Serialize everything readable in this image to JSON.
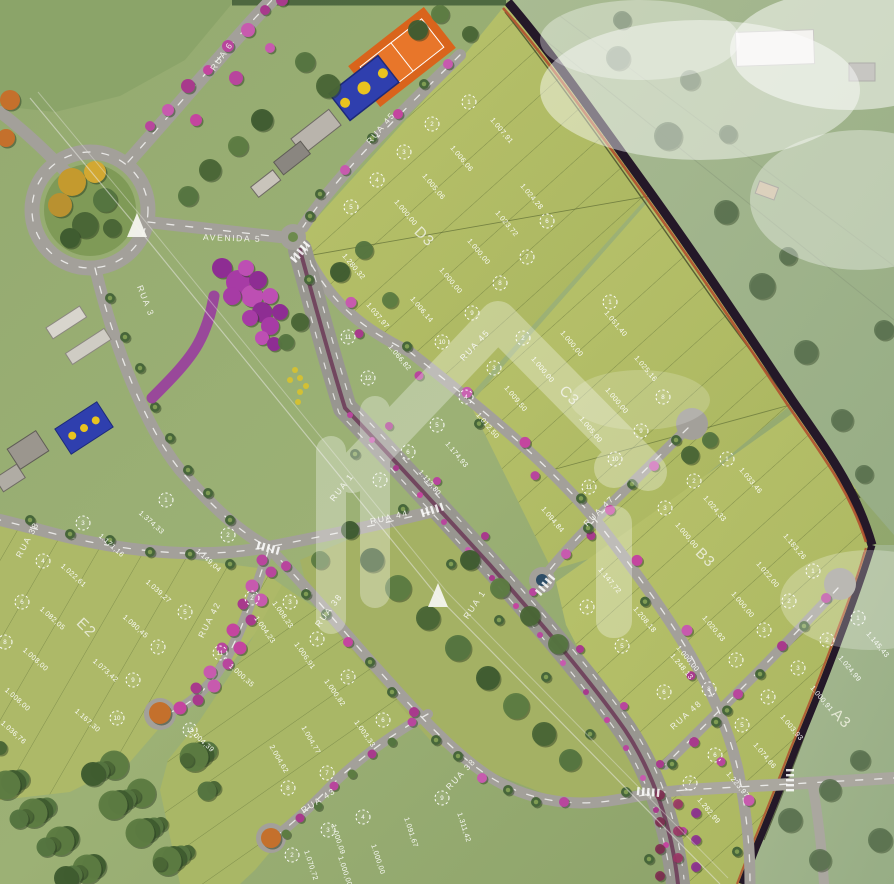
{
  "map": {
    "streets": [
      {
        "label": "RUA 6",
        "x": 224,
        "y": 58,
        "rot": -55
      },
      {
        "label": "AVENIDA 5",
        "x": 232,
        "y": 241,
        "rot": 2
      },
      {
        "label": "RUA 3",
        "x": 143,
        "y": 302,
        "rot": 68
      },
      {
        "label": "RUA 45",
        "x": 383,
        "y": 130,
        "rot": -50
      },
      {
        "label": "RUA 45",
        "x": 477,
        "y": 347,
        "rot": -47
      },
      {
        "label": "RUA 1",
        "x": 344,
        "y": 489,
        "rot": -52
      },
      {
        "label": "RUA 1",
        "x": 477,
        "y": 606,
        "rot": -56
      },
      {
        "label": "RUA 44",
        "x": 390,
        "y": 520,
        "rot": -13
      },
      {
        "label": "RUA 38",
        "x": 30,
        "y": 541,
        "rot": -62
      },
      {
        "label": "RUA 38",
        "x": 331,
        "y": 612,
        "rot": -53
      },
      {
        "label": "RUA 38",
        "x": 463,
        "y": 776,
        "rot": -47
      },
      {
        "label": "RUA 42",
        "x": 212,
        "y": 621,
        "rot": -63
      },
      {
        "label": "RUA 43",
        "x": 320,
        "y": 803,
        "rot": -33
      },
      {
        "label": "RUA 47",
        "x": 601,
        "y": 513,
        "rot": -45
      },
      {
        "label": "RUA 48",
        "x": 688,
        "y": 717,
        "rot": -42
      }
    ],
    "blocks": [
      {
        "label": "D3",
        "x": 421,
        "y": 240,
        "rot": 45
      },
      {
        "label": "C3",
        "x": 566,
        "y": 399,
        "rot": 45
      },
      {
        "label": "B3",
        "x": 702,
        "y": 561,
        "rot": 45
      },
      {
        "label": "A3",
        "x": 838,
        "y": 722,
        "rot": 45
      },
      {
        "label": "E2",
        "x": 83,
        "y": 631,
        "rot": 45
      }
    ],
    "lots": [
      {
        "n": "1",
        "x": 469,
        "y": 102,
        "area": "1.007,91",
        "ax": 500,
        "ay": 132,
        "rot": 50
      },
      {
        "n": "2",
        "x": 432,
        "y": 124,
        "area": "1.006,06",
        "ax": 460,
        "ay": 160,
        "rot": 50
      },
      {
        "n": "3",
        "x": 404,
        "y": 152,
        "area": "1.005,06",
        "ax": 432,
        "ay": 188,
        "rot": 50
      },
      {
        "n": "4",
        "x": 377,
        "y": 180,
        "area": "1.000,00",
        "ax": 404,
        "ay": 214,
        "rot": 50
      },
      {
        "n": "5",
        "x": 351,
        "y": 207,
        "area": "1.280,32",
        "ax": 352,
        "ay": 268,
        "rot": 50
      },
      {
        "n": "6",
        "x": 547,
        "y": 221,
        "area": "1.024,28",
        "ax": 530,
        "ay": 198,
        "rot": 50
      },
      {
        "n": "7",
        "x": 527,
        "y": 257,
        "area": "1.023,72",
        "ax": 505,
        "ay": 225,
        "rot": 50
      },
      {
        "n": "8",
        "x": 500,
        "y": 283,
        "area": "1.000,00",
        "ax": 477,
        "ay": 253,
        "rot": 50
      },
      {
        "n": "9",
        "x": 472,
        "y": 313,
        "area": "1.000,00",
        "ax": 449,
        "ay": 282,
        "rot": 50
      },
      {
        "n": "10",
        "x": 442,
        "y": 342,
        "area": "1.006,14",
        "ax": 420,
        "ay": 311,
        "rot": 50
      },
      {
        "n": "11",
        "x": 348,
        "y": 337,
        "area": "1.037,97",
        "ax": 376,
        "ay": 317,
        "rot": 50
      },
      {
        "n": "12",
        "x": 368,
        "y": 378,
        "area": "1.066,82",
        "ax": 398,
        "ay": 359,
        "rot": 50
      },
      {
        "n": "1",
        "x": 610,
        "y": 302,
        "area": "1.051,40",
        "ax": 614,
        "ay": 325,
        "rot": 50
      },
      {
        "n": "2",
        "x": 523,
        "y": 338,
        "area": "1.000,00",
        "ax": 570,
        "ay": 345,
        "rot": 50
      },
      {
        "n": "3",
        "x": 494,
        "y": 368,
        "area": "1.000,00",
        "ax": 541,
        "ay": 371,
        "rot": 50
      },
      {
        "n": "4",
        "x": 466,
        "y": 397,
        "area": "1.009,50",
        "ax": 514,
        "ay": 400,
        "rot": 50
      },
      {
        "n": "5",
        "x": 437,
        "y": 425,
        "area": "1.012,50",
        "ax": 486,
        "ay": 427,
        "rot": 50
      },
      {
        "n": "6",
        "x": 408,
        "y": 452,
        "area": "1.174,93",
        "ax": 455,
        "ay": 456,
        "rot": 50
      },
      {
        "n": "7",
        "x": 380,
        "y": 480,
        "area": "1.113,80",
        "ax": 428,
        "ay": 484,
        "rot": 50
      },
      {
        "n": "8",
        "x": 663,
        "y": 397,
        "area": "1.025,16",
        "ax": 644,
        "ay": 370,
        "rot": 50
      },
      {
        "n": "9",
        "x": 641,
        "y": 431,
        "area": "1.000,00",
        "ax": 615,
        "ay": 402,
        "rot": 50
      },
      {
        "n": "10",
        "x": 615,
        "y": 459,
        "area": "1.005,00",
        "ax": 589,
        "ay": 431,
        "rot": 50
      },
      {
        "n": "11",
        "x": 589,
        "y": 487,
        "area": "1.094,84",
        "ax": 551,
        "ay": 521,
        "rot": 50
      },
      {
        "n": "1",
        "x": 727,
        "y": 459,
        "area": "1.033,46",
        "ax": 749,
        "ay": 482,
        "rot": 50
      },
      {
        "n": "2",
        "x": 694,
        "y": 481,
        "area": "1.024,33",
        "ax": 713,
        "ay": 510,
        "rot": 50
      },
      {
        "n": "3",
        "x": 665,
        "y": 508,
        "area": "1.000,00",
        "ax": 685,
        "ay": 537,
        "rot": 50
      },
      {
        "n": "1",
        "x": 813,
        "y": 571,
        "area": "1.183,26",
        "ax": 793,
        "ay": 548,
        "rot": 50
      },
      {
        "n": "2",
        "x": 789,
        "y": 601,
        "area": "1.022,00",
        "ax": 766,
        "ay": 576,
        "rot": 50
      },
      {
        "n": "3",
        "x": 764,
        "y": 630,
        "area": "1.000,00",
        "ax": 741,
        "ay": 606,
        "rot": 50
      },
      {
        "n": "4",
        "x": 587,
        "y": 607,
        "area": "1.147,72",
        "ax": 608,
        "ay": 582,
        "rot": 50
      },
      {
        "n": "5",
        "x": 622,
        "y": 646,
        "area": "1.208,18",
        "ax": 643,
        "ay": 621,
        "rot": 50
      },
      {
        "n": "6",
        "x": 664,
        "y": 692,
        "area": "1.248,13",
        "ax": 680,
        "ay": 668,
        "rot": 50
      },
      {
        "n": "7",
        "x": 736,
        "y": 660,
        "area": "1.020,93",
        "ax": 712,
        "ay": 630,
        "rot": 50
      },
      {
        "n": "8",
        "x": 709,
        "y": 689,
        "area": "1.000,00",
        "ax": 686,
        "ay": 660,
        "rot": 50
      },
      {
        "n": "1",
        "x": 858,
        "y": 618,
        "area": "1.145,43",
        "ax": 876,
        "ay": 646,
        "rot": 50
      },
      {
        "n": "2",
        "x": 827,
        "y": 640,
        "area": "1.024,99",
        "ax": 848,
        "ay": 670,
        "rot": 50
      },
      {
        "n": "3",
        "x": 798,
        "y": 668,
        "area": "1.000,91",
        "ax": 820,
        "ay": 700,
        "rot": 50
      },
      {
        "n": "4",
        "x": 768,
        "y": 697,
        "area": "1.003,93",
        "ax": 790,
        "ay": 729,
        "rot": 50
      },
      {
        "n": "5",
        "x": 742,
        "y": 725,
        "area": "1.074,66",
        "ax": 763,
        "ay": 757,
        "rot": 50
      },
      {
        "n": "6",
        "x": 715,
        "y": 755,
        "area": "1.223,97",
        "ax": 736,
        "ay": 786,
        "rot": 50
      },
      {
        "n": "7",
        "x": 690,
        "y": 783,
        "area": "1.282,99",
        "ax": 707,
        "ay": 812,
        "rot": 50
      },
      {
        "n": "1",
        "x": 166,
        "y": 500,
        "area": "1.374,33",
        "ax": 150,
        "ay": 524,
        "rot": 42
      },
      {
        "n": "2",
        "x": 228,
        "y": 535,
        "area": "1.149,04",
        "ax": 207,
        "ay": 562,
        "rot": 42
      },
      {
        "n": "3",
        "x": 83,
        "y": 523,
        "area": "1.171,16",
        "ax": 110,
        "ay": 547,
        "rot": 42
      },
      {
        "n": "4",
        "x": 43,
        "y": 561,
        "area": "1.022,61",
        "ax": 72,
        "ay": 577,
        "rot": 42
      },
      {
        "n": "5",
        "x": 185,
        "y": 612,
        "area": "1.039,27",
        "ax": 157,
        "ay": 593,
        "rot": 42
      },
      {
        "n": "6",
        "x": 22,
        "y": 602,
        "area": "1.082,05",
        "ax": 51,
        "ay": 620,
        "rot": 42
      },
      {
        "n": "7",
        "x": 158,
        "y": 647,
        "area": "1.080,45",
        "ax": 134,
        "ay": 628,
        "rot": 42
      },
      {
        "n": "8",
        "x": 5,
        "y": 642,
        "area": "1.008,00",
        "ax": 34,
        "ay": 661,
        "rot": 42
      },
      {
        "n": "9",
        "x": 133,
        "y": 680,
        "area": "1.073,42",
        "ax": 104,
        "ay": 672,
        "rot": 42
      },
      {
        "n": "10",
        "x": 117,
        "y": 718,
        "area": "1.167,30",
        "ax": 86,
        "ay": 722,
        "rot": 42
      },
      {
        "n": "11",
        "x": 220,
        "y": 653,
        "area": "1.000,35",
        "ax": 240,
        "ay": 677,
        "rot": 42
      },
      {
        "n": "13",
        "x": 190,
        "y": 730,
        "area": "2.004,39",
        "ax": 200,
        "ay": 742,
        "rot": 42
      },
      {
        "area": "1.008,00",
        "ax": 16,
        "ay": 701,
        "rot": 42
      },
      {
        "area": "1.036,76",
        "ax": 12,
        "ay": 734,
        "rot": 42
      },
      {
        "n": "2",
        "x": 252,
        "y": 598,
        "area": "1.004,23",
        "ax": 263,
        "ay": 631,
        "rot": 55
      },
      {
        "n": "3",
        "x": 290,
        "y": 602,
        "area": "1.008,23",
        "ax": 281,
        "ay": 616,
        "rot": 55
      },
      {
        "n": "4",
        "x": 317,
        "y": 639,
        "area": "1.006,91",
        "ax": 303,
        "ay": 657,
        "rot": 55
      },
      {
        "n": "5",
        "x": 348,
        "y": 677,
        "area": "1.000,82",
        "ax": 333,
        "ay": 694,
        "rot": 55
      },
      {
        "n": "6",
        "x": 383,
        "y": 720,
        "area": "1.003,33",
        "ax": 363,
        "ay": 735,
        "rot": 55
      },
      {
        "area": "1.004,77",
        "ax": 309,
        "ay": 741,
        "rot": 60
      },
      {
        "area": "2.004,62",
        "ax": 277,
        "ay": 760,
        "rot": 60
      },
      {
        "n": "7",
        "x": 327,
        "y": 773,
        "area": "1.070,72",
        "ax": 309,
        "ay": 866,
        "rot": 72
      },
      {
        "n": "8",
        "x": 288,
        "y": 788,
        "area": "1.000,00",
        "ax": 343,
        "ay": 872,
        "rot": 72
      },
      {
        "n": "9",
        "x": 442,
        "y": 798,
        "area": "1.311,42",
        "ax": 462,
        "ay": 828,
        "rot": 72
      },
      {
        "n": "4",
        "x": 363,
        "y": 817,
        "area": "1.091,67",
        "ax": 409,
        "ay": 833,
        "rot": 72
      },
      {
        "n": "3",
        "x": 328,
        "y": 830,
        "area": "1.000,00",
        "ax": 376,
        "ay": 860,
        "rot": 72
      },
      {
        "n": "2",
        "x": 292,
        "y": 855,
        "area": "1.000,09",
        "ax": 336,
        "ay": 840,
        "rot": 72
      }
    ],
    "colors": {
      "lot_field": "#afba64",
      "outside_field": "#a2b68c",
      "road": "#a3a09a",
      "boundary_dark": "#241828",
      "boundary_orange": "#b0502e",
      "flower_pink": "#c4459f",
      "court_orange": "#d9641c",
      "court_blue": "#2f3fae",
      "label_white": "#ffffff"
    }
  }
}
